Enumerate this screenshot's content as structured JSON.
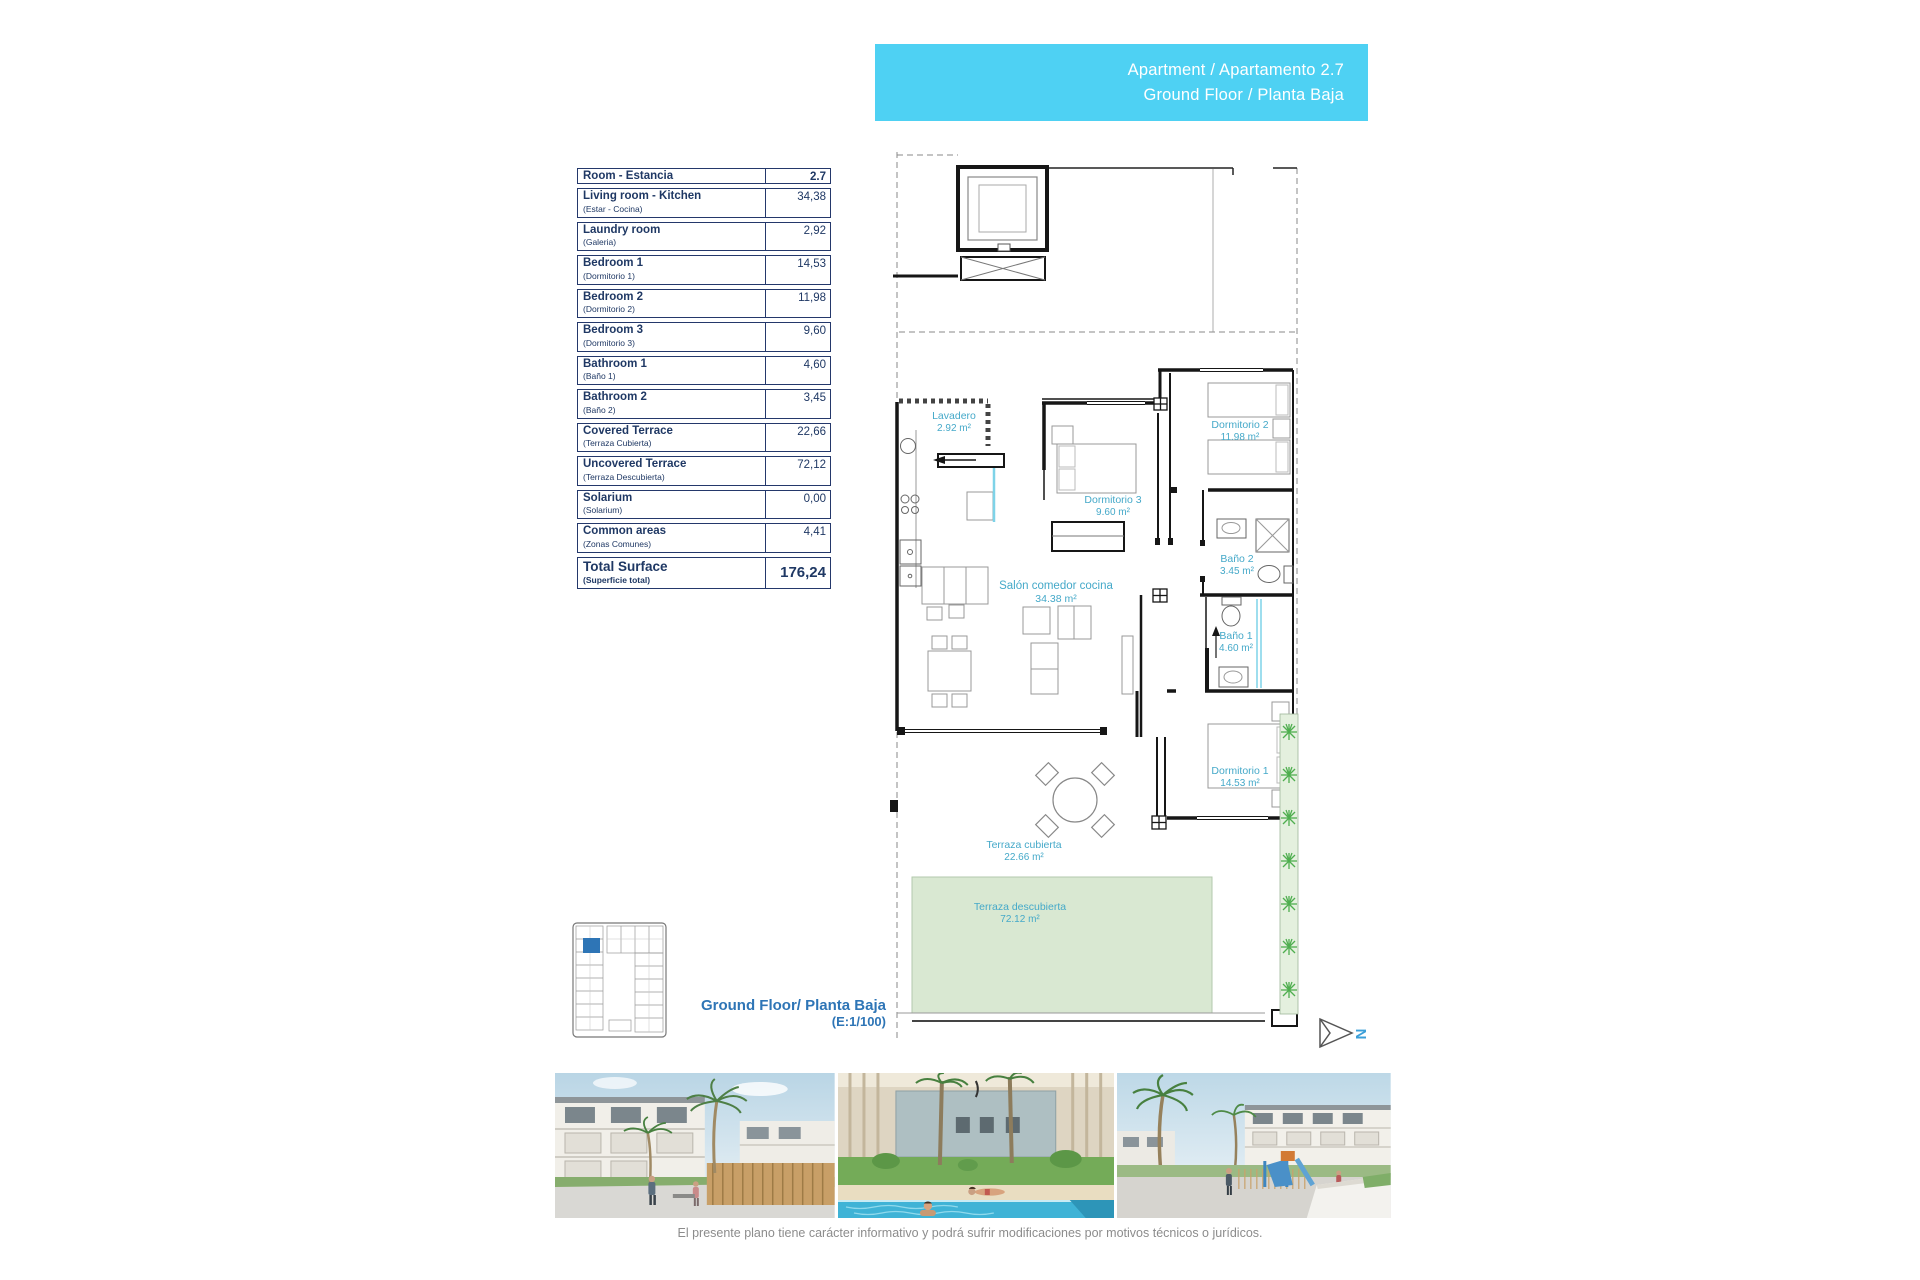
{
  "header": {
    "line1": "Apartment / Apartamento 2.7",
    "line2": "Ground Floor / Planta Baja"
  },
  "area_table": {
    "header": {
      "name": "Room - Estancia",
      "value": "2.7"
    },
    "rows": [
      {
        "en": "Living room - Kitchen",
        "es": "(Estar - Cocina)",
        "value": "34,38"
      },
      {
        "en": "Laundry room",
        "es": "(Galeria)",
        "value": "2,92"
      },
      {
        "en": "Bedroom 1",
        "es": "(Dormitorio 1)",
        "value": "14,53"
      },
      {
        "en": "Bedroom 2",
        "es": "(Dormitorio 2)",
        "value": "11,98"
      },
      {
        "en": "Bedroom 3",
        "es": "(Dormitorio 3)",
        "value": "9,60"
      },
      {
        "en": "Bathroom 1",
        "es": "(Baño 1)",
        "value": "4,60"
      },
      {
        "en": "Bathroom 2",
        "es": "(Baño 2)",
        "value": "3,45"
      },
      {
        "en": "Covered Terrace",
        "es": "(Terraza Cubierta)",
        "value": "22,66"
      },
      {
        "en": "Uncovered Terrace",
        "es": "(Terraza Descubierta)",
        "value": "72,12"
      },
      {
        "en": "Solarium",
        "es": "(Solarium)",
        "value": "0,00"
      },
      {
        "en": "Common areas",
        "es": "(Zonas Comunes)",
        "value": "4,41"
      }
    ],
    "total": {
      "en": "Total Surface",
      "es": "(Superficie total)",
      "value": "176,24"
    }
  },
  "plan": {
    "labels": [
      {
        "id": "lavadero",
        "name": "Lavadero",
        "area": "2.92 m²"
      },
      {
        "id": "dormitorio3",
        "name": "Dormitorio 3",
        "area": "9.60 m²"
      },
      {
        "id": "dormitorio2",
        "name": "Dormitorio 2",
        "area": "11.98 m²"
      },
      {
        "id": "bano2",
        "name": "Baño 2",
        "area": "3.45 m²"
      },
      {
        "id": "salon",
        "name": "Salón comedor cocina",
        "area": "34.38 m²"
      },
      {
        "id": "bano1",
        "name": "Baño 1",
        "area": "4.60 m²"
      },
      {
        "id": "dormitorio1",
        "name": "Dormitorio 1",
        "area": "14.53 m²"
      },
      {
        "id": "terraza_cubierta",
        "name": "Terraza cubierta",
        "area": "22.66 m²"
      },
      {
        "id": "terraza_descubierta",
        "name": "Terraza descubierta",
        "area": "72.12 m²"
      }
    ],
    "north_label": "N"
  },
  "floor_label": {
    "line1": "Ground Floor/ Planta Baja",
    "line2": "(E:1/100)"
  },
  "photos": [
    {
      "name": "apartments-street-render"
    },
    {
      "name": "pool-area-render"
    },
    {
      "name": "playground-render"
    }
  ],
  "footer": {
    "disclaimer": "El presente plano tiene carácter informativo y podrá sufrir modificaciones por motivos técnicos o jurídicos."
  },
  "colors": {
    "header_bg": "#4ed1f3",
    "table_navy": "#1f3864",
    "plan_label_cyan": "#45a9c9",
    "floor_label_blue": "#2e75b6",
    "keyplan_highlight": "#2e75b6",
    "terrace_green": "#d9e8d2",
    "plant_green": "#4fae4f",
    "north_n_blue": "#3b9fd8"
  }
}
